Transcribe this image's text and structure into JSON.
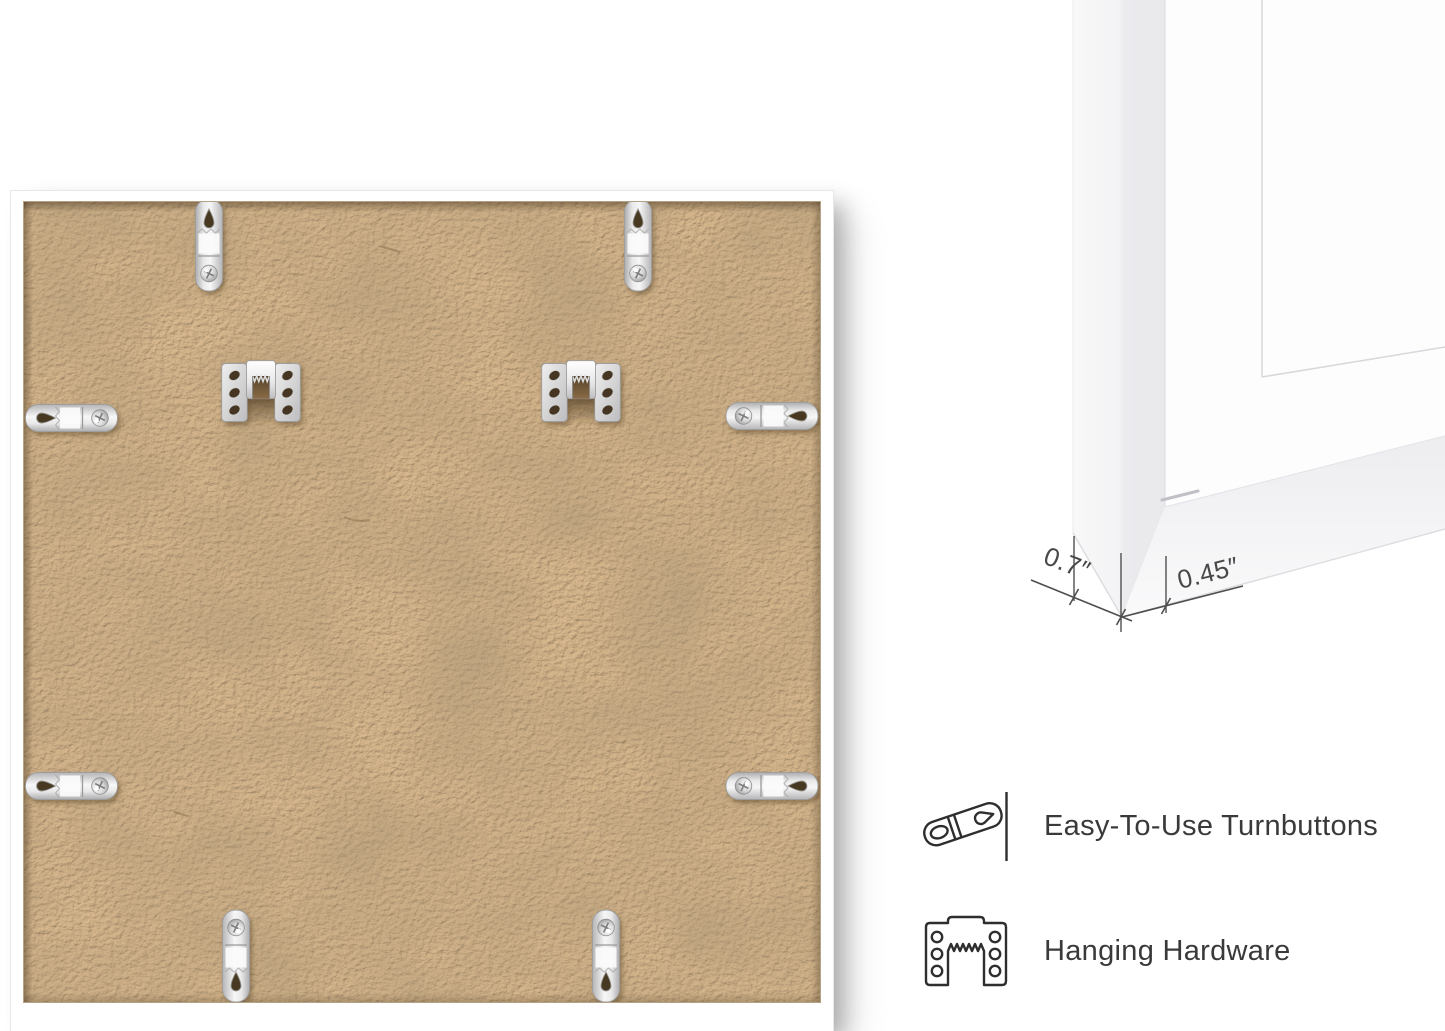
{
  "page": {
    "background_color": "#ffffff"
  },
  "back_view": {
    "frame_color": "#ffffff",
    "backing_color": "#c9a77e",
    "turnbutton_tab_count": 8,
    "sawtooth_hanger_count": 2
  },
  "corner_closeup": {
    "depth_label": "0.7″",
    "face_label": "0.45″"
  },
  "features": [
    {
      "icon": "turnbutton-icon",
      "label": "Easy-To-Use Turnbuttons"
    },
    {
      "icon": "hanging-hardware-icon",
      "label": "Hanging Hardware"
    }
  ],
  "colors": {
    "feature_text": "#3a3a3a",
    "dimension_lines": "#4f4f4f",
    "icon_stroke": "#2e2e2e",
    "metal_light": "#f7f7f8",
    "metal_dark": "#b5b5b7",
    "hole_dark": "#463723"
  }
}
